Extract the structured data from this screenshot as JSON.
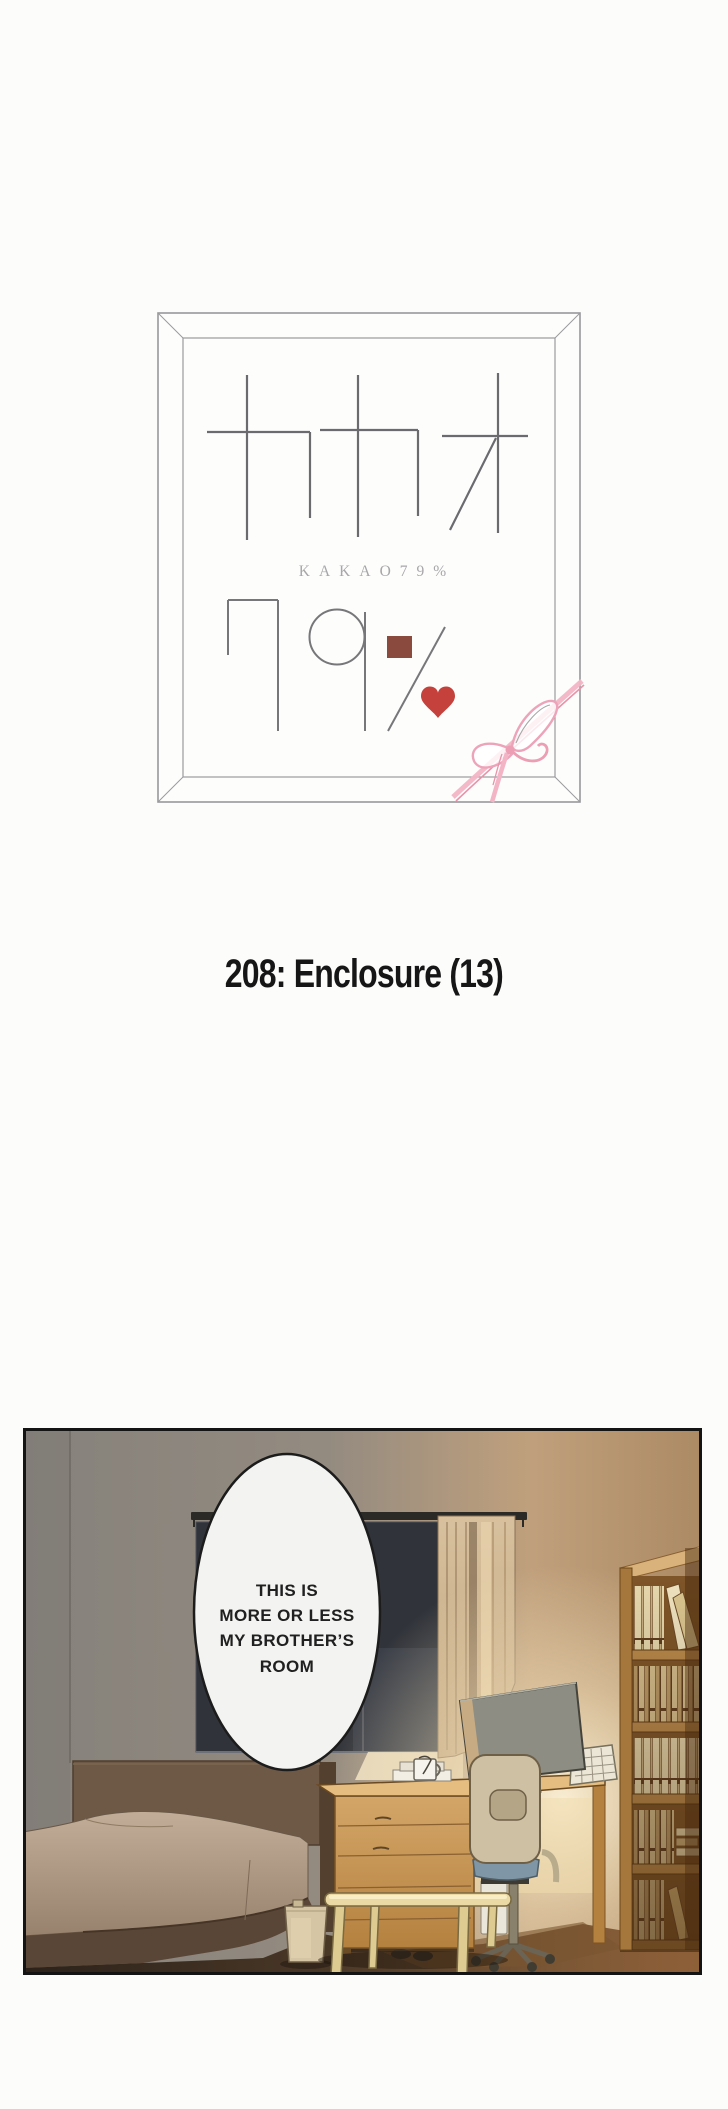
{
  "page": {
    "background": "#fcfcfb"
  },
  "logo": {
    "katakana": "カカオ",
    "romanized": "KAKAO79%",
    "number": "79%",
    "colors": {
      "line": "#6b6b6f",
      "frame": "#98989b",
      "subtitle": "#a8a6a8",
      "chocolate_square": "#8a4a3d",
      "heart": "#c5413b",
      "ribbon": "#f0a8bd"
    }
  },
  "chapter": {
    "title": "208: Enclosure (13)"
  },
  "panel": {
    "speech_bubble": {
      "lines": [
        "THIS IS",
        "MORE OR LESS",
        "MY BROTHER’S",
        "ROOM"
      ],
      "fill": "#f3f3f1",
      "stroke": "#1c1c1c"
    },
    "objects": [
      "window",
      "curtain",
      "bed",
      "dresser-desk",
      "monitor",
      "office-chair",
      "bench",
      "trash-can",
      "bookshelf"
    ],
    "palette": {
      "wall_left": "#85817b",
      "wall_warm": "#c0a07c",
      "window_glass": "#2f3237",
      "curtain": "#cdb294",
      "bed": "#b7a28c",
      "blanket_dark": "#5a4636",
      "wood": "#c99a5e",
      "bookshelf": "#a5773d",
      "floor_dark": "#2c221a",
      "floor_warm": "#8f6038",
      "glow": "#fff6dc",
      "chair_seat": "#7e96a6"
    }
  }
}
